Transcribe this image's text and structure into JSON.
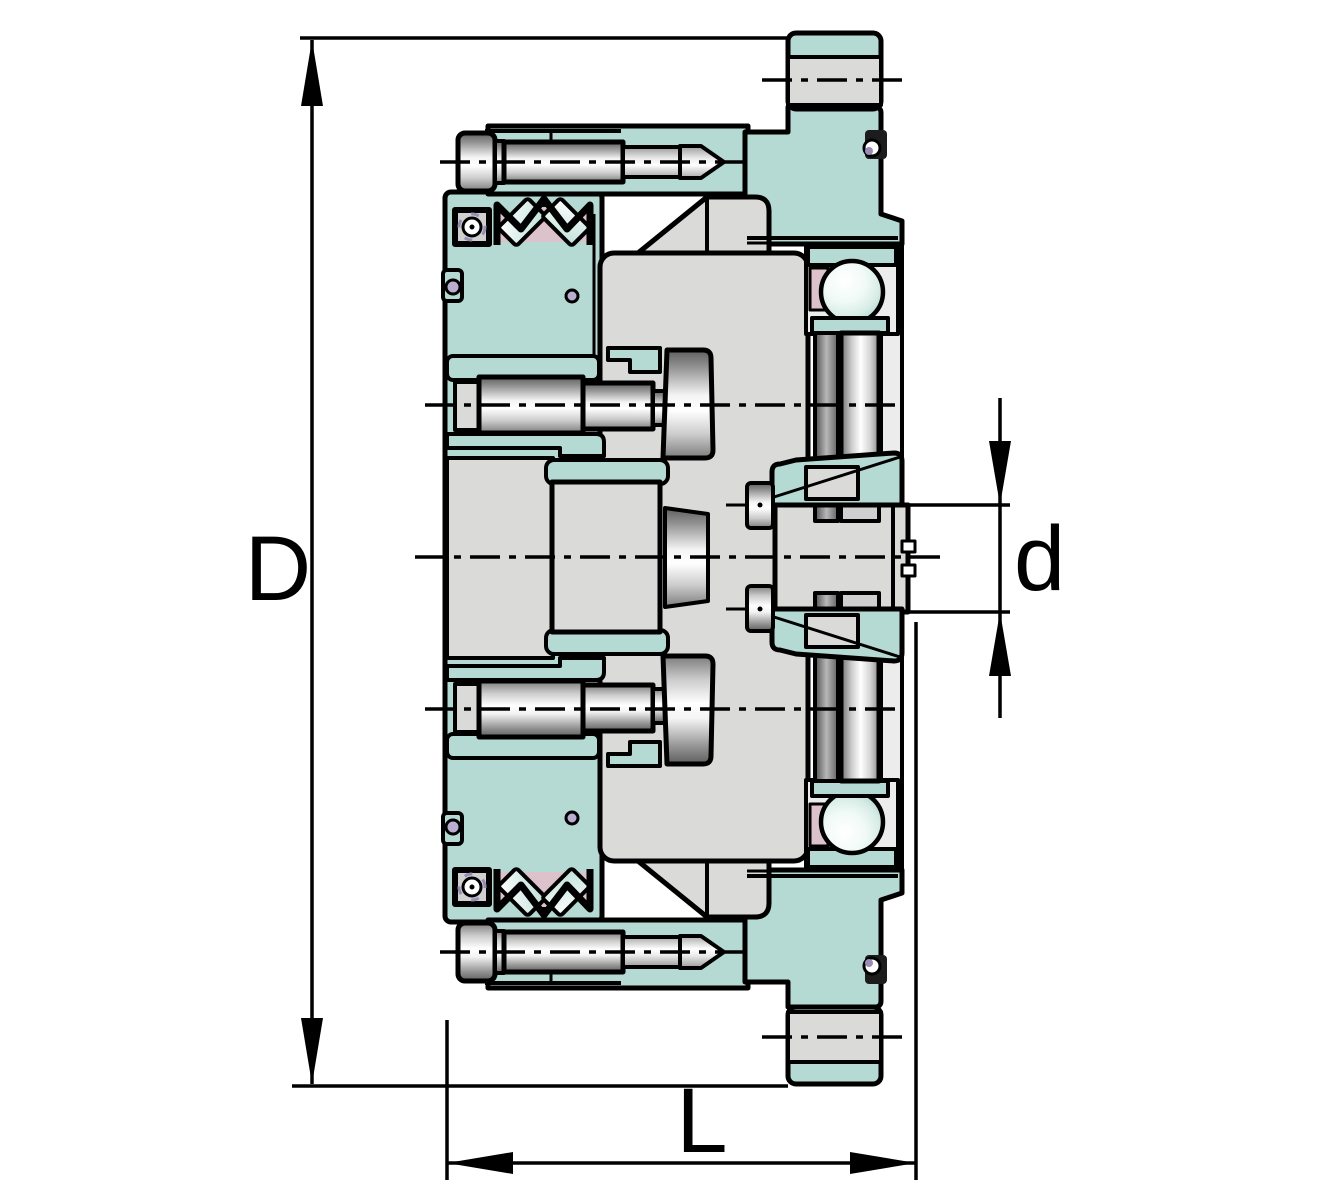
{
  "drawing": {
    "kind": "planetary-gear-unit-cross-section",
    "labels": {
      "outer_diameter": "D",
      "shaft_diameter": "d",
      "length": "L"
    },
    "colors": {
      "housing_teal": "#b5d9d3",
      "section_gray": "#dadbd9",
      "outline": "#000000",
      "background": "#ffffff",
      "seal_pink": "#dcc2ca",
      "plug_purple": "#9b8cb5",
      "ball_mint": "#d7ece6"
    }
  }
}
